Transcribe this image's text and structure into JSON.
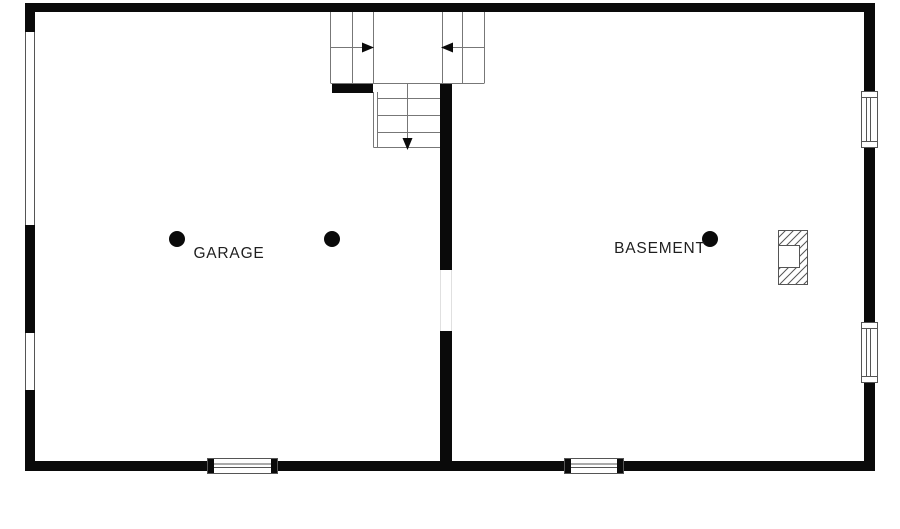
{
  "plan": {
    "rooms": [
      {
        "name": "garage",
        "label": "GARAGE"
      },
      {
        "name": "basement",
        "label": "BASEMENT"
      }
    ],
    "colors": {
      "background": "#ffffff",
      "wall": "#0a0a0a",
      "thin_line": "#777777",
      "window_line": "#555555",
      "faint_line": "#e0e0e0",
      "text": "#1f1f1f"
    },
    "markers": {
      "column_dot_count": 3
    },
    "stairs": {
      "up_arrow_count": 2,
      "down_arrow_count": 1
    },
    "windows": {
      "left_wall_count": 2,
      "right_wall_count": 2,
      "bottom_wall_count": 2
    },
    "chimney_present": true
  }
}
